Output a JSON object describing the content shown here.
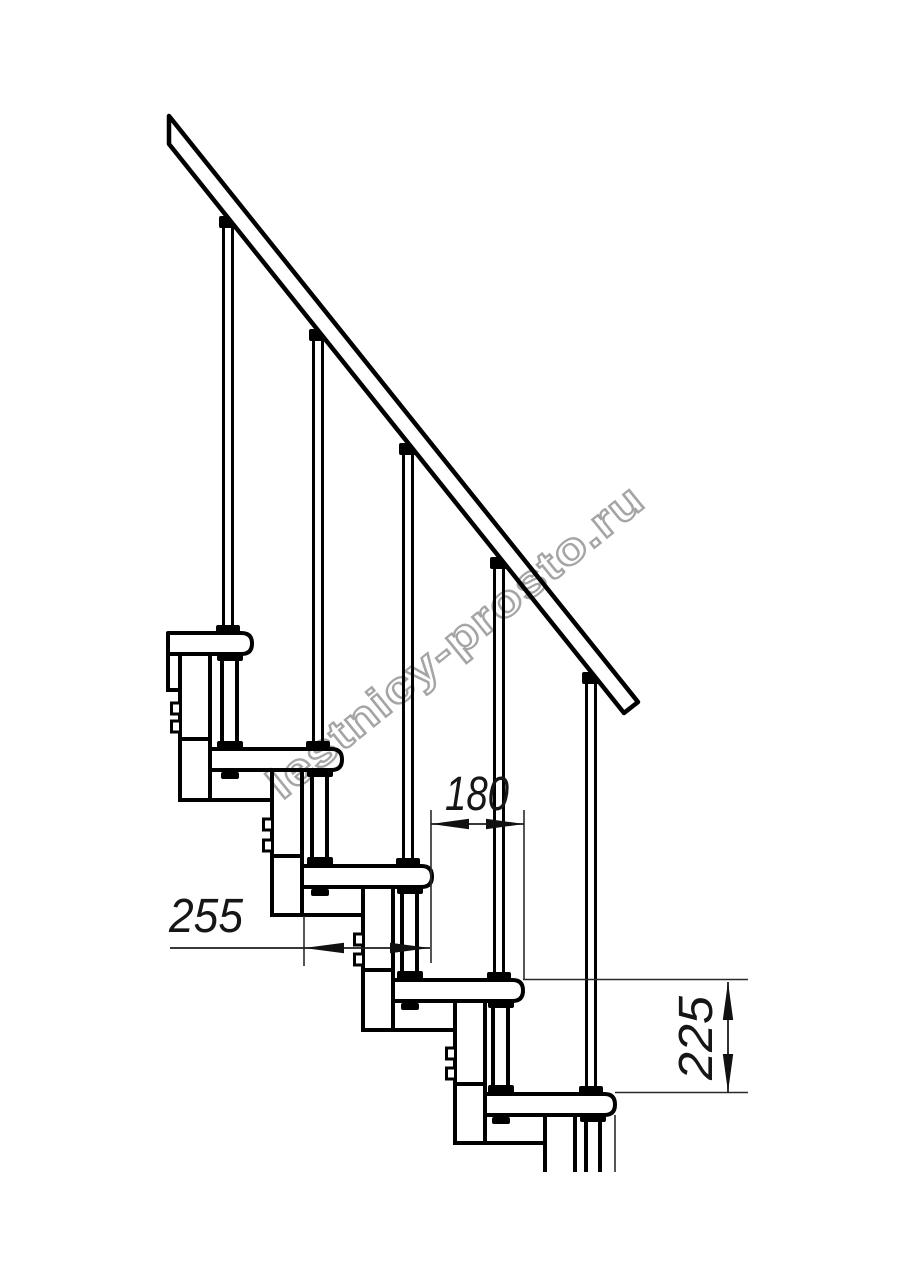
{
  "drawing": {
    "description_colors": {
      "line": "#000000",
      "dim_line": "#2a2a2a",
      "dim_text": "#161616"
    },
    "dimensions": [
      {
        "id": "tread-run",
        "label": "180"
      },
      {
        "id": "tread-depth",
        "label": "255"
      },
      {
        "id": "step-rise",
        "label": "225"
      }
    ]
  },
  "watermark": {
    "text": "lestnicy-prosto.ru",
    "color": "#a5a5a5"
  }
}
